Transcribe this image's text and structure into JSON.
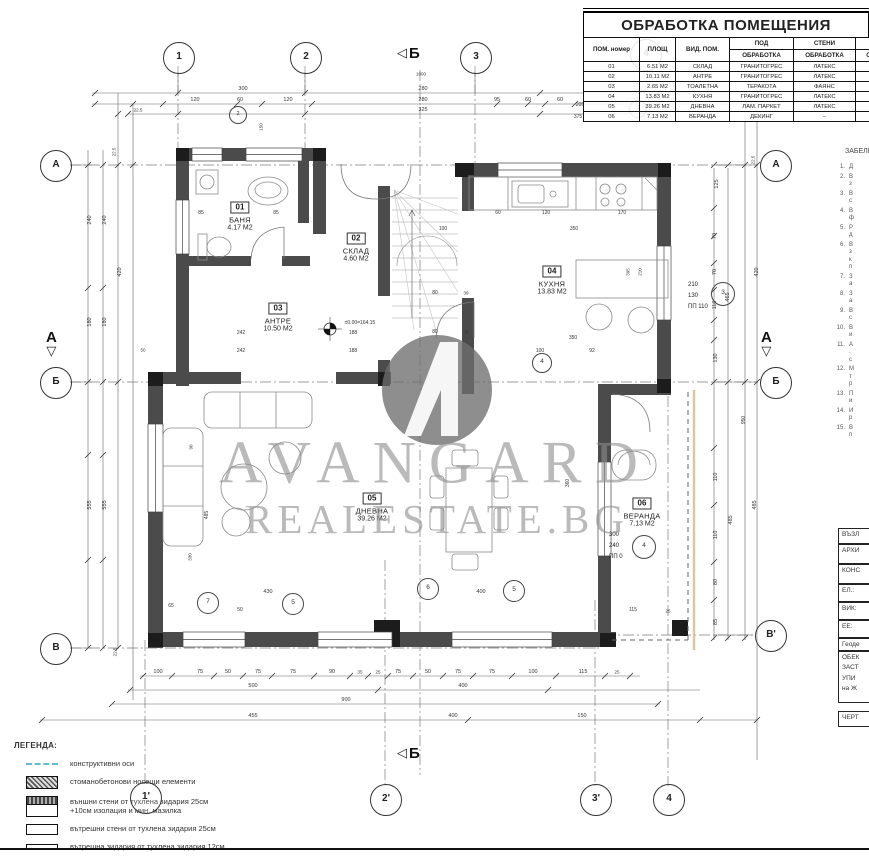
{
  "icons": {
    "tri_left": "◁",
    "tri_down": "▽"
  },
  "finishes": {
    "title": "ОБРАБОТКА ПОМЕЩЕНИЯ",
    "h1": {
      "num": "ПОМ. номер",
      "area": "ПЛОЩ",
      "type": "ВИД. ПОМ.",
      "floor": "ПОД",
      "walls": "СТЕНИ",
      "ceiling": "ТАВАН"
    },
    "sub": "ОБРАБОТКА",
    "rows": [
      [
        "01",
        "6.51 М2",
        "СКЛАД",
        "ГРАНИТОГРЕС",
        "ЛАТЕКС",
        "ЛАТЕКС"
      ],
      [
        "02",
        "10.11 М2",
        "АНТРЕ",
        "ГРАНИТОГРЕС",
        "ЛАТЕКС",
        "ЛАТЕКС"
      ],
      [
        "03",
        "2.65 М2",
        "ТОАЛЕТНА",
        "ТЕРАКОТА",
        "ФАЯНС",
        "ЛАТЕКС"
      ],
      [
        "04",
        "13.83 М2",
        "КУХНЯ",
        "ГРАНИТОГРЕС",
        "ЛАТЕКС",
        "ЛАТЕКС"
      ],
      [
        "05",
        "39.26 М2",
        "ДНЕВНА",
        "ЛАМ. ПАРКЕТ",
        "ЛАТЕКС",
        "ЛАТЕКС"
      ],
      [
        "06",
        "7.13 М2",
        "ВЕРАНДА",
        "ДЕКИНГ",
        "–",
        ""
      ]
    ]
  },
  "notes": {
    "header": "ЗАБЕЛЕЖКИ",
    "items": [
      {
        "n": "1.",
        "lines": [
          "Д"
        ]
      },
      {
        "n": "2.",
        "lines": [
          "В",
          "з"
        ]
      },
      {
        "n": "3.",
        "lines": [
          "В",
          "с"
        ]
      },
      {
        "n": "4.",
        "lines": [
          "В",
          "ф"
        ]
      },
      {
        "n": "5.",
        "lines": [
          "Р",
          "д"
        ]
      },
      {
        "n": "6.",
        "lines": [
          "В",
          "з",
          "к",
          "п"
        ]
      },
      {
        "n": "7.",
        "lines": [
          "З",
          "а"
        ]
      },
      {
        "n": "8.",
        "lines": [
          "З",
          "а"
        ]
      },
      {
        "n": "9.",
        "lines": [
          "В",
          "с"
        ]
      },
      {
        "n": "10.",
        "lines": [
          "В",
          "и"
        ]
      },
      {
        "n": "11.",
        "lines": [
          "А",
          ".",
          "с"
        ]
      },
      {
        "n": "12.",
        "lines": [
          "М",
          "т",
          "р"
        ]
      },
      {
        "n": "13.",
        "lines": [
          "П",
          "и"
        ]
      },
      {
        "n": "14.",
        "lines": [
          "И",
          "р"
        ]
      },
      {
        "n": "15.",
        "lines": [
          "В",
          "п"
        ]
      }
    ]
  },
  "titleblock": {
    "rows": [
      {
        "t": "ВЪЗЛ",
        "h": 16
      },
      {
        "t": "АРХИ",
        "h": 20
      },
      {
        "t": "КОНС",
        "h": 20
      },
      {
        "t": "ЕЛ.:",
        "h": 18
      },
      {
        "t": "ВИК:",
        "h": 18
      },
      {
        "t": "ЕЕ:",
        "h": 18
      },
      {
        "t": "Геоде",
        "h": 13
      },
      {
        "t": "ОБЕК\nЗАСТ\nУПИ\nна Ж",
        "h": 52
      },
      {
        "t": "ЧЕРТ",
        "h": 16,
        "gap": 8
      }
    ]
  },
  "legend": {
    "title": "ЛЕГЕНДА:",
    "items": [
      {
        "swatch": "sw-axis",
        "label": "конструктивни оси"
      },
      {
        "swatch": "sw-conc",
        "label": "стоманобетонови носещи елементи"
      },
      {
        "swatch": "sw-ext",
        "label": "външни стени от тухлена зидария 25см\n+10см изолация и мин. мазилка"
      },
      {
        "swatch": "sw-25",
        "label": "вътрешни стени от тухлена зидария 25см"
      },
      {
        "swatch": "sw-12",
        "label": "вътрешна зидария от тухлена зидария 12см"
      }
    ]
  },
  "watermark": {
    "line1": "AVANGARD",
    "line2": "REALESTATE.BG"
  },
  "rooms": [
    {
      "num": "01",
      "name": "БАНЯ",
      "area": "4.17 М2",
      "x": 240,
      "y": 214
    },
    {
      "num": "02",
      "name": "СКЛАД",
      "area": "4.60 М2",
      "x": 356,
      "y": 245
    },
    {
      "num": "03",
      "name": "АНТРЕ",
      "area": "10.50 М2",
      "x": 278,
      "y": 315
    },
    {
      "num": "04",
      "name": "КУХНЯ",
      "area": "13.83 М2",
      "x": 552,
      "y": 278
    },
    {
      "num": "05",
      "name": "ДНЕВНА",
      "area": "39.26 М2",
      "x": 372,
      "y": 505
    },
    {
      "num": "06",
      "name": "ВЕРАНДА",
      "area": "7.13 М2",
      "x": 642,
      "y": 510
    }
  ],
  "axes": [
    {
      "t": "1",
      "x": 178,
      "y": 57
    },
    {
      "t": "2",
      "x": 305,
      "y": 57
    },
    {
      "t": "3",
      "x": 475,
      "y": 57
    },
    {
      "t": "4",
      "x": 645,
      "y": 54,
      "z": 7
    },
    {
      "t": "1'",
      "x": 145,
      "y": 797
    },
    {
      "t": "2'",
      "x": 385,
      "y": 799
    },
    {
      "t": "3'",
      "x": 595,
      "y": 799
    },
    {
      "t": "4",
      "x": 668,
      "y": 799
    },
    {
      "t": "А",
      "x": 55,
      "y": 165
    },
    {
      "t": "Б",
      "x": 55,
      "y": 382
    },
    {
      "t": "В",
      "x": 55,
      "y": 648
    },
    {
      "t": "А",
      "x": 775,
      "y": 165
    },
    {
      "t": "Б",
      "x": 775,
      "y": 382
    },
    {
      "t": "В'",
      "x": 770,
      "y": 635
    }
  ],
  "section_marks": [
    {
      "t": "Б",
      "x": 397,
      "y": 46,
      "dir": "left"
    },
    {
      "t": "Б",
      "x": 397,
      "y": 746,
      "dir": "left"
    },
    {
      "t": "А",
      "x": 46,
      "y": 330,
      "dir": "down"
    },
    {
      "t": "А",
      "x": 761,
      "y": 330,
      "dir": "down"
    }
  ],
  "window_marks": [
    {
      "t": "2",
      "x": 237,
      "y": 114,
      "r": 8
    },
    {
      "t": "4",
      "x": 637,
      "y": 108,
      "r": 8
    },
    {
      "t": "3",
      "x": 722,
      "y": 293,
      "r": 11
    },
    {
      "t": "4",
      "x": 643,
      "y": 546,
      "r": 11
    },
    {
      "t": "5",
      "x": 513,
      "y": 590,
      "r": 10
    },
    {
      "t": "6",
      "x": 427,
      "y": 588,
      "r": 10
    },
    {
      "t": "7",
      "x": 207,
      "y": 602,
      "r": 10
    },
    {
      "t": "5",
      "x": 292,
      "y": 603,
      "r": 10
    },
    {
      "t": "4",
      "x": 541,
      "y": 362,
      "r": 9
    }
  ],
  "window_specs": [
    {
      "lines": [
        "210",
        "130",
        "ПП  110"
      ],
      "x": 688,
      "y": 280
    },
    {
      "lines": [
        "300",
        "240",
        "ПП  0"
      ],
      "x": 609,
      "y": 530
    }
  ],
  "dims": [
    {
      "t": "300",
      "x": 243,
      "y": 89
    },
    {
      "t": "280",
      "x": 423,
      "y": 89
    },
    {
      "t": "120",
      "x": 195,
      "y": 100
    },
    {
      "t": "60",
      "x": 240,
      "y": 100
    },
    {
      "t": "120",
      "x": 288,
      "y": 100
    },
    {
      "t": "280",
      "x": 423,
      "y": 100
    },
    {
      "t": "95",
      "x": 497,
      "y": 100
    },
    {
      "t": "60",
      "x": 528,
      "y": 100
    },
    {
      "t": "60",
      "x": 560,
      "y": 100
    },
    {
      "t": "22.5",
      "x": 138,
      "y": 110,
      "s": 4.5
    },
    {
      "t": "325",
      "x": 423,
      "y": 110
    },
    {
      "t": "1000",
      "x": 421,
      "y": 74,
      "s": 4.5
    },
    {
      "t": "420",
      "x": 641,
      "y": 92,
      "s": 5,
      "z": 7
    },
    {
      "t": "205",
      "x": 580,
      "y": 105,
      "s": 5,
      "z": 7
    },
    {
      "t": "375",
      "x": 578,
      "y": 117,
      "s": 5,
      "z": 7
    },
    {
      "t": "150",
      "x": 261,
      "y": 127,
      "r": 1,
      "s": 4.5
    },
    {
      "t": "22.5",
      "x": 114,
      "y": 152,
      "r": 1,
      "s": 4.5
    },
    {
      "t": "240",
      "x": 90,
      "y": 220,
      "r": 1
    },
    {
      "t": "240",
      "x": 105,
      "y": 220,
      "r": 1
    },
    {
      "t": "420",
      "x": 120,
      "y": 272,
      "r": 1
    },
    {
      "t": "180",
      "x": 90,
      "y": 322,
      "r": 1
    },
    {
      "t": "180",
      "x": 105,
      "y": 322,
      "r": 1
    },
    {
      "t": "50",
      "x": 143,
      "y": 350,
      "s": 4.5
    },
    {
      "t": "555",
      "x": 90,
      "y": 505,
      "r": 1
    },
    {
      "t": "555",
      "x": 105,
      "y": 505,
      "r": 1
    },
    {
      "t": "22.5",
      "x": 115,
      "y": 652,
      "r": 1,
      "s": 4.5
    },
    {
      "t": "85",
      "x": 201,
      "y": 213,
      "s": 5
    },
    {
      "t": "85",
      "x": 276,
      "y": 213,
      "s": 5
    },
    {
      "t": "±0.00=164.15",
      "x": 360,
      "y": 323,
      "s": 5
    },
    {
      "t": "242",
      "x": 241,
      "y": 333,
      "s": 5
    },
    {
      "t": "188",
      "x": 353,
      "y": 333,
      "s": 5
    },
    {
      "t": "242",
      "x": 241,
      "y": 351,
      "s": 5
    },
    {
      "t": "188",
      "x": 353,
      "y": 351,
      "s": 5
    },
    {
      "t": "100",
      "x": 443,
      "y": 229,
      "s": 5
    },
    {
      "t": "80",
      "x": 435,
      "y": 293,
      "s": 5
    },
    {
      "t": "39",
      "x": 466,
      "y": 293,
      "s": 4.5
    },
    {
      "t": "80",
      "x": 435,
      "y": 332,
      "s": 5
    },
    {
      "t": "39",
      "x": 466,
      "y": 332,
      "s": 4.5
    },
    {
      "t": "60",
      "x": 498,
      "y": 213,
      "s": 5
    },
    {
      "t": "120",
      "x": 546,
      "y": 213,
      "s": 5
    },
    {
      "t": "170",
      "x": 622,
      "y": 213,
      "s": 5
    },
    {
      "t": "350",
      "x": 574,
      "y": 229,
      "s": 5
    },
    {
      "t": "350",
      "x": 573,
      "y": 338,
      "s": 5
    },
    {
      "t": "100",
      "x": 540,
      "y": 351,
      "s": 5
    },
    {
      "t": "92",
      "x": 592,
      "y": 351,
      "s": 5
    },
    {
      "t": "395",
      "x": 628,
      "y": 272,
      "r": 1,
      "s": 4.5
    },
    {
      "t": "210",
      "x": 640,
      "y": 272,
      "r": 1,
      "s": 4.5
    },
    {
      "t": "360",
      "x": 568,
      "y": 483,
      "r": 1,
      "s": 5
    },
    {
      "t": "400",
      "x": 481,
      "y": 592
    },
    {
      "t": "430",
      "x": 268,
      "y": 592
    },
    {
      "t": "65",
      "x": 171,
      "y": 606,
      "s": 5
    },
    {
      "t": "50",
      "x": 240,
      "y": 610,
      "s": 5
    },
    {
      "t": "90",
      "x": 191,
      "y": 447,
      "r": 1,
      "s": 4.5
    },
    {
      "t": "485",
      "x": 207,
      "y": 515,
      "r": 1,
      "s": 5
    },
    {
      "t": "330",
      "x": 190,
      "y": 557,
      "r": 1,
      "s": 4.5
    },
    {
      "t": "115",
      "x": 633,
      "y": 610,
      "s": 5
    },
    {
      "t": "25",
      "x": 668,
      "y": 611,
      "s": 4.5
    },
    {
      "t": "125",
      "x": 717,
      "y": 184,
      "r": 1
    },
    {
      "t": "70",
      "x": 715,
      "y": 236,
      "r": 1
    },
    {
      "t": "70",
      "x": 715,
      "y": 272,
      "r": 1
    },
    {
      "t": "110",
      "x": 715,
      "y": 305,
      "r": 1
    },
    {
      "t": "130",
      "x": 716,
      "y": 358,
      "r": 1
    },
    {
      "t": "465",
      "x": 728,
      "y": 297,
      "r": 1
    },
    {
      "t": "420",
      "x": 757,
      "y": 272,
      "r": 1
    },
    {
      "t": "22.5",
      "x": 753,
      "y": 160,
      "r": 1,
      "s": 4.5
    },
    {
      "t": "950",
      "x": 744,
      "y": 420,
      "r": 1,
      "s": 5
    },
    {
      "t": "110",
      "x": 716,
      "y": 477,
      "r": 1
    },
    {
      "t": "110",
      "x": 716,
      "y": 535,
      "r": 1
    },
    {
      "t": "80",
      "x": 716,
      "y": 582,
      "r": 1
    },
    {
      "t": "85",
      "x": 716,
      "y": 622,
      "r": 1
    },
    {
      "t": "485",
      "x": 731,
      "y": 520,
      "r": 1
    },
    {
      "t": "485",
      "x": 755,
      "y": 505,
      "r": 1
    },
    {
      "t": "100",
      "x": 158,
      "y": 672
    },
    {
      "t": "75",
      "x": 200,
      "y": 672
    },
    {
      "t": "50",
      "x": 228,
      "y": 672
    },
    {
      "t": "75",
      "x": 258,
      "y": 672
    },
    {
      "t": "75",
      "x": 293,
      "y": 672
    },
    {
      "t": "90",
      "x": 332,
      "y": 672
    },
    {
      "t": "35",
      "x": 360,
      "y": 672,
      "s": 4.5
    },
    {
      "t": "25",
      "x": 378,
      "y": 672,
      "s": 4.5
    },
    {
      "t": "75",
      "x": 398,
      "y": 672
    },
    {
      "t": "50",
      "x": 428,
      "y": 672
    },
    {
      "t": "75",
      "x": 458,
      "y": 672
    },
    {
      "t": "75",
      "x": 492,
      "y": 672
    },
    {
      "t": "100",
      "x": 533,
      "y": 672
    },
    {
      "t": "115",
      "x": 583,
      "y": 672
    },
    {
      "t": "25",
      "x": 617,
      "y": 672,
      "s": 4.5
    },
    {
      "t": "500",
      "x": 253,
      "y": 686
    },
    {
      "t": "400",
      "x": 463,
      "y": 686
    },
    {
      "t": "900",
      "x": 346,
      "y": 700
    },
    {
      "t": "455",
      "x": 253,
      "y": 716
    },
    {
      "t": "400",
      "x": 453,
      "y": 716
    },
    {
      "t": "150",
      "x": 582,
      "y": 716
    }
  ]
}
